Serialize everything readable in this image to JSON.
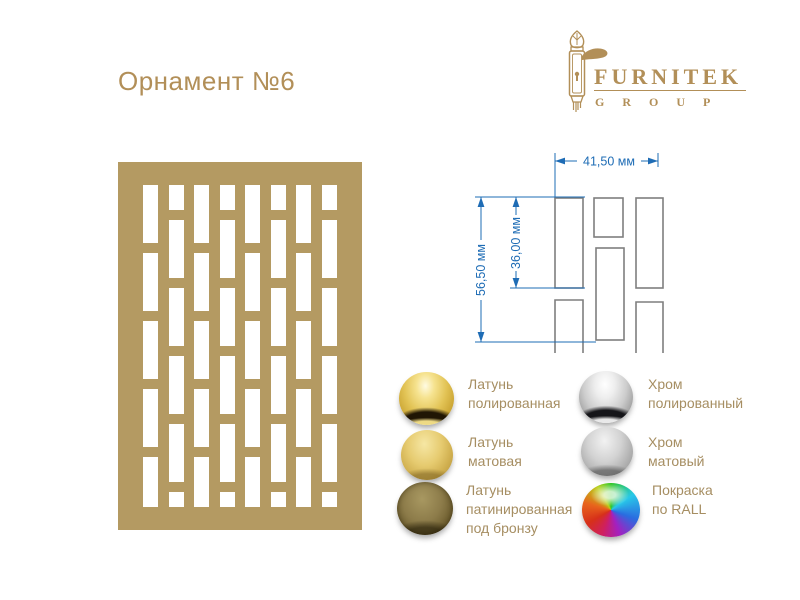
{
  "page": {
    "title": "Орнамент №6"
  },
  "logo": {
    "brand": "FURNITEK",
    "group": "G R O U P",
    "color": "#b28f58",
    "icon": "door-handle"
  },
  "panel": {
    "color": "#b49a62",
    "hole_color": "#ffffff"
  },
  "drawing": {
    "width_label": "41,50 мм",
    "outer_height_label": "56,50 мм",
    "inner_height_label": "36,00 мм",
    "dimension_color": "#1e6cb5",
    "outline_color": "#7f7f7f"
  },
  "finishes": {
    "label_color": "#a68e62",
    "left": [
      {
        "name": "brass-polished",
        "label": "Латунь\nполированная"
      },
      {
        "name": "brass-matte",
        "label": "Латунь\nматовая"
      },
      {
        "name": "brass-patinated",
        "label": "Латунь\nпатинированная\nпод бронзу"
      }
    ],
    "right": [
      {
        "name": "chrome-polished",
        "label": "Хром\nполированный"
      },
      {
        "name": "chrome-matte",
        "label": "Хром\nматовый"
      },
      {
        "name": "ral-paint",
        "label": "Покраска\nпо RALL"
      }
    ]
  }
}
